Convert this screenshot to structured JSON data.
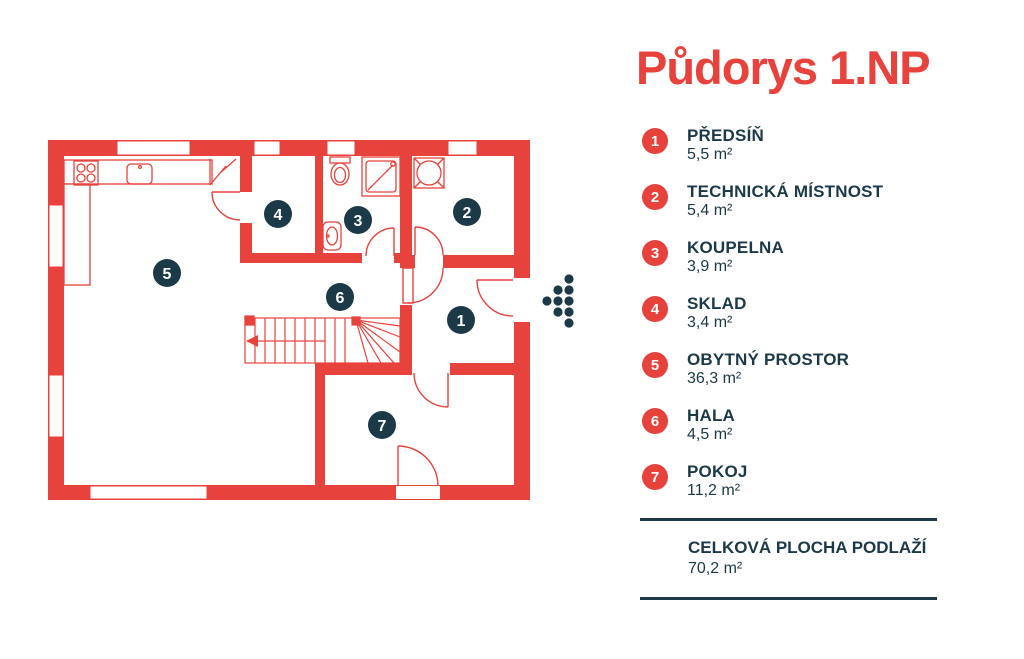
{
  "title": "Půdorys 1.NP",
  "colors": {
    "accent_red": "#e8423c",
    "navy": "#1c3948"
  },
  "legend": {
    "items": [
      {
        "number": "1",
        "name": "PŘEDSÍŇ",
        "area": "5,5 m²"
      },
      {
        "number": "2",
        "name": "TECHNICKÁ MÍSTNOST",
        "area": "5,4 m²"
      },
      {
        "number": "3",
        "name": "KOUPELNA",
        "area": "3,9 m²"
      },
      {
        "number": "4",
        "name": "SKLAD",
        "area": "3,4 m²"
      },
      {
        "number": "5",
        "name": "OBYTNÝ PROSTOR",
        "area": "36,3 m²"
      },
      {
        "number": "6",
        "name": "HALA",
        "area": "4,5 m²"
      },
      {
        "number": "7",
        "name": "POKOJ",
        "area": "11,2 m²"
      }
    ],
    "total": {
      "label": "CELKOVÁ PLOCHA PODLAŽÍ",
      "value": "70,2 m²"
    }
  }
}
